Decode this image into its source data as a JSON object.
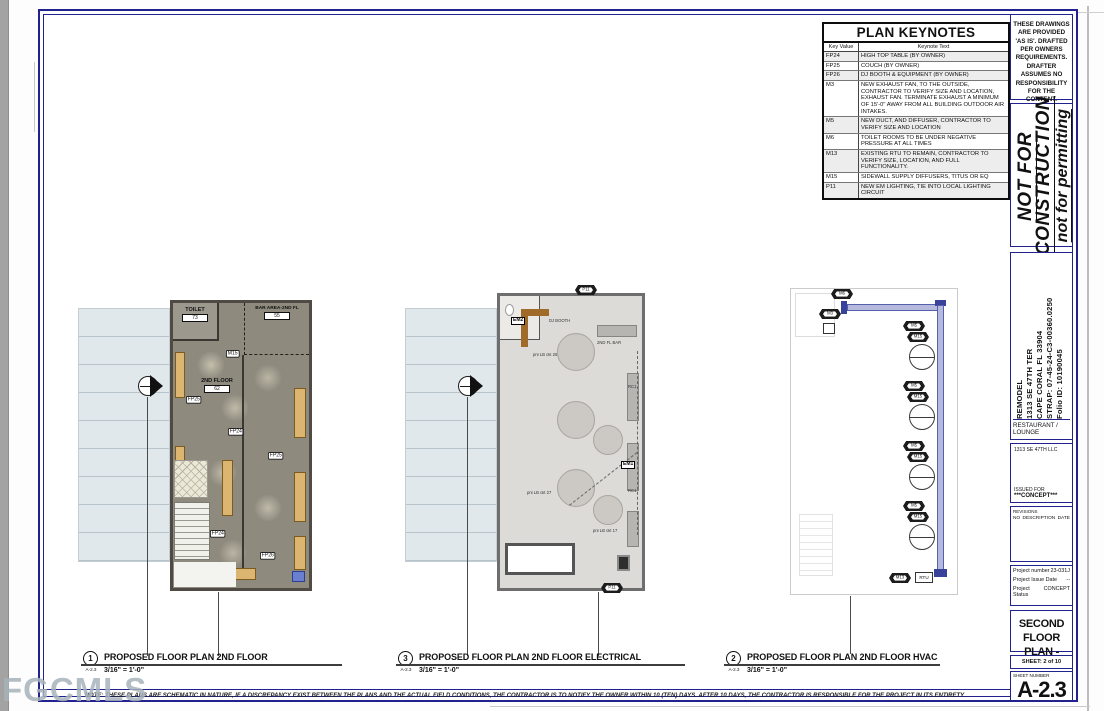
{
  "keynotes": {
    "title": "PLAN KEYNOTES",
    "col_key": "Key Value",
    "col_text": "Keynote Text",
    "rows": [
      {
        "key": "FP24",
        "text": "HIGH TOP TABLE (BY OWNER)"
      },
      {
        "key": "FP25",
        "text": "COUCH (BY OWNER)"
      },
      {
        "key": "FP26",
        "text": "DJ BOOTH & EQUIPMENT (BY OWNER)"
      },
      {
        "key": "M3",
        "text": "NEW EXHAUST FAN, TO THE OUTSIDE, CONTRACTOR TO VERIFY SIZE AND LOCATION, EXHAUST FAN. TERMINATE EXHAUST A MINIMUM OF 15'-0\" AWAY FROM ALL BUILDING OUTDOOR AIR INTAKES."
      },
      {
        "key": "M5",
        "text": "NEW DUCT, AND DIFFUSER, CONTRACTOR TO VERIFY SIZE AND LOCATION"
      },
      {
        "key": "M6",
        "text": "TOILET ROOMS TO BE UNDER NEGATIVE PRESSURE AT ALL TIMES"
      },
      {
        "key": "M13",
        "text": "EXISTING RTU TO REMAIN, CONTRACTOR TO VERIFY SIZE, LOCATION, AND FULL FUNCTIONALITY."
      },
      {
        "key": "M15",
        "text": "SIDEWALL SUPPLY DIFFUSERS, TITUS OR EQ"
      },
      {
        "key": "P11",
        "text": "NEW EM LIGHTING, TIE INTO LOCAL LIGHTING CIRCUIT"
      }
    ]
  },
  "titleblock": {
    "disclaimer": "THESE DRAWINGS ARE PROVIDED 'AS IS'. DRAFTED PER OWNERS REQUIREMENTS. DRAFTER ASSUMES NO RESPONSIBILITY FOR THE CONTENT.",
    "nfc1": "NOT FOR",
    "nfc2": "CONSTRUCTION",
    "permitting": "not for permitting",
    "project": {
      "name": "REMODEL",
      "addr1": "1313 SE 47TH TER",
      "addr2": "CAPE CORAL FL 33904",
      "strap": "STRAP: 07-45-24-C3-00360.0250",
      "folio": "Folio ID: 10190045"
    },
    "use": "RESTAURANT / LOUNGE",
    "owner": "1313 SE 47TH LLC",
    "issued_label": "ISSUED FOR",
    "issued_value": "***CONCEPT***",
    "revisions": {
      "label": "REVISIONS",
      "no": "NO",
      "desc": "DESCRIPTION",
      "date": "DATE"
    },
    "meta": {
      "pn_label": "Project number",
      "pn_value": "23-031J",
      "date_label": "Project Issue Date",
      "date_value": "--",
      "status_label": "Project Status",
      "status_value": "CONCEPT"
    },
    "title1": "SECOND FLOOR",
    "title2": "PLAN - LOUNGE",
    "sheet_of": "SHEET: 2 of 10",
    "sn_label": "SHEET NUMBER",
    "sn_value": "A-2.3"
  },
  "plan1": {
    "rooms": {
      "toilet": {
        "name": "TOILET",
        "number": "73"
      },
      "bar": {
        "name": "BAR AREA-2ND FL",
        "number": "55"
      },
      "floor": {
        "name": "2ND FLOOR",
        "number": "62"
      }
    },
    "tags": [
      "M15",
      "FP25",
      "FP24",
      "FP25",
      "FP24",
      "FP26"
    ]
  },
  "plan2": {
    "labels": {
      "dj": "DJ BOOTH",
      "bar": "2ND FL BAR"
    },
    "tags": {
      "em2": "EM2",
      "em1": "EM1",
      "rc1": "RC1",
      "p11": "P11"
    },
    "circuits": [
      "pnl LB ckt 25",
      "pnl LB ckt 27",
      "pnl LB ckt 17"
    ]
  },
  "plan3": {
    "tags": {
      "m6": "M6",
      "m3": "M3",
      "m5": "M5",
      "m15": "M15",
      "m13": "M13"
    },
    "rtu": "RTU"
  },
  "plan_labels": [
    {
      "num": "1",
      "ref": "A-2.3",
      "title": "PROPOSED FLOOR PLAN 2ND FLOOR",
      "scale": "3/16\" = 1'-0\""
    },
    {
      "num": "3",
      "ref": "A-2.3",
      "title": "PROPOSED FLOOR PLAN 2ND FLOOR ELECTRICAL",
      "scale": "3/16\" = 1'-0\""
    },
    {
      "num": "2",
      "ref": "A-2.3",
      "title": "PROPOSED FLOOR PLAN 2ND FLOOR HVAC",
      "scale": "3/16\" = 1'-0\""
    }
  ],
  "note": "NOTE: THESE PLANS ARE SCHEMATIC IN NATURE, IF A DISCREPANCY EXIST BETWEEN THE PLANS AND THE ACTUAL FIELD CONDITIONS, THE CONTRACTOR IS TO NOTIFY THE OWNER WITHIN 10 (TEN) DAYS. AFTER 10 DAYS, THE CONTRACTOR IS RESPONSIBLE FOR THE PROJECT IN ITS ENTIRETY.",
  "watermark": "FGCMLS",
  "colors": {
    "border_navy": "#22228e",
    "duct_blue": "#b5badd",
    "couch_tan": "#dcb571",
    "roof_band": "#e0e8ec",
    "floor_grey": "#8e8a7e"
  }
}
